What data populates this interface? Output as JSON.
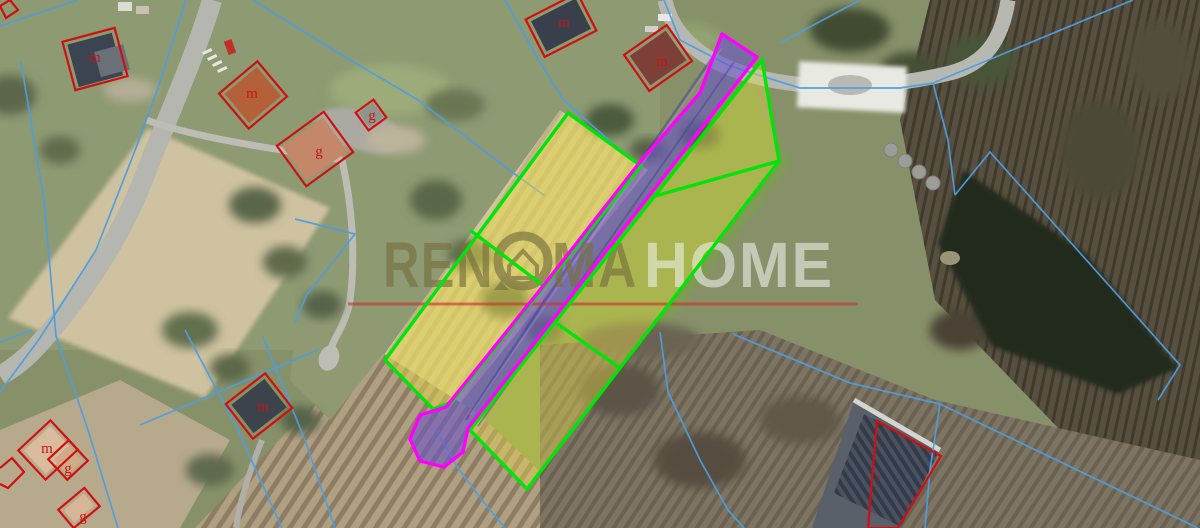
{
  "watermark": {
    "part1": "REN",
    "part2": "MA",
    "part3": "HOME",
    "primary_color": "#76713f",
    "secondary_color": "#f2f2ee",
    "underline_color": "#cd2d2d"
  },
  "labels": {
    "color": "#c41414",
    "items": [
      "m",
      "m",
      "g",
      "g",
      "m",
      "m",
      "m",
      "g",
      "g",
      "m",
      "i"
    ]
  },
  "overlay": {
    "highlight_parcel_outline": "#00e408",
    "highlight_parcel_fill": "#e6d84a",
    "access_strip_outline": "#ff00ff",
    "access_strip_fill": "#6a55c8",
    "cadastral_line_color": "#4d9ee0",
    "building_outline_color": "#d01010"
  }
}
